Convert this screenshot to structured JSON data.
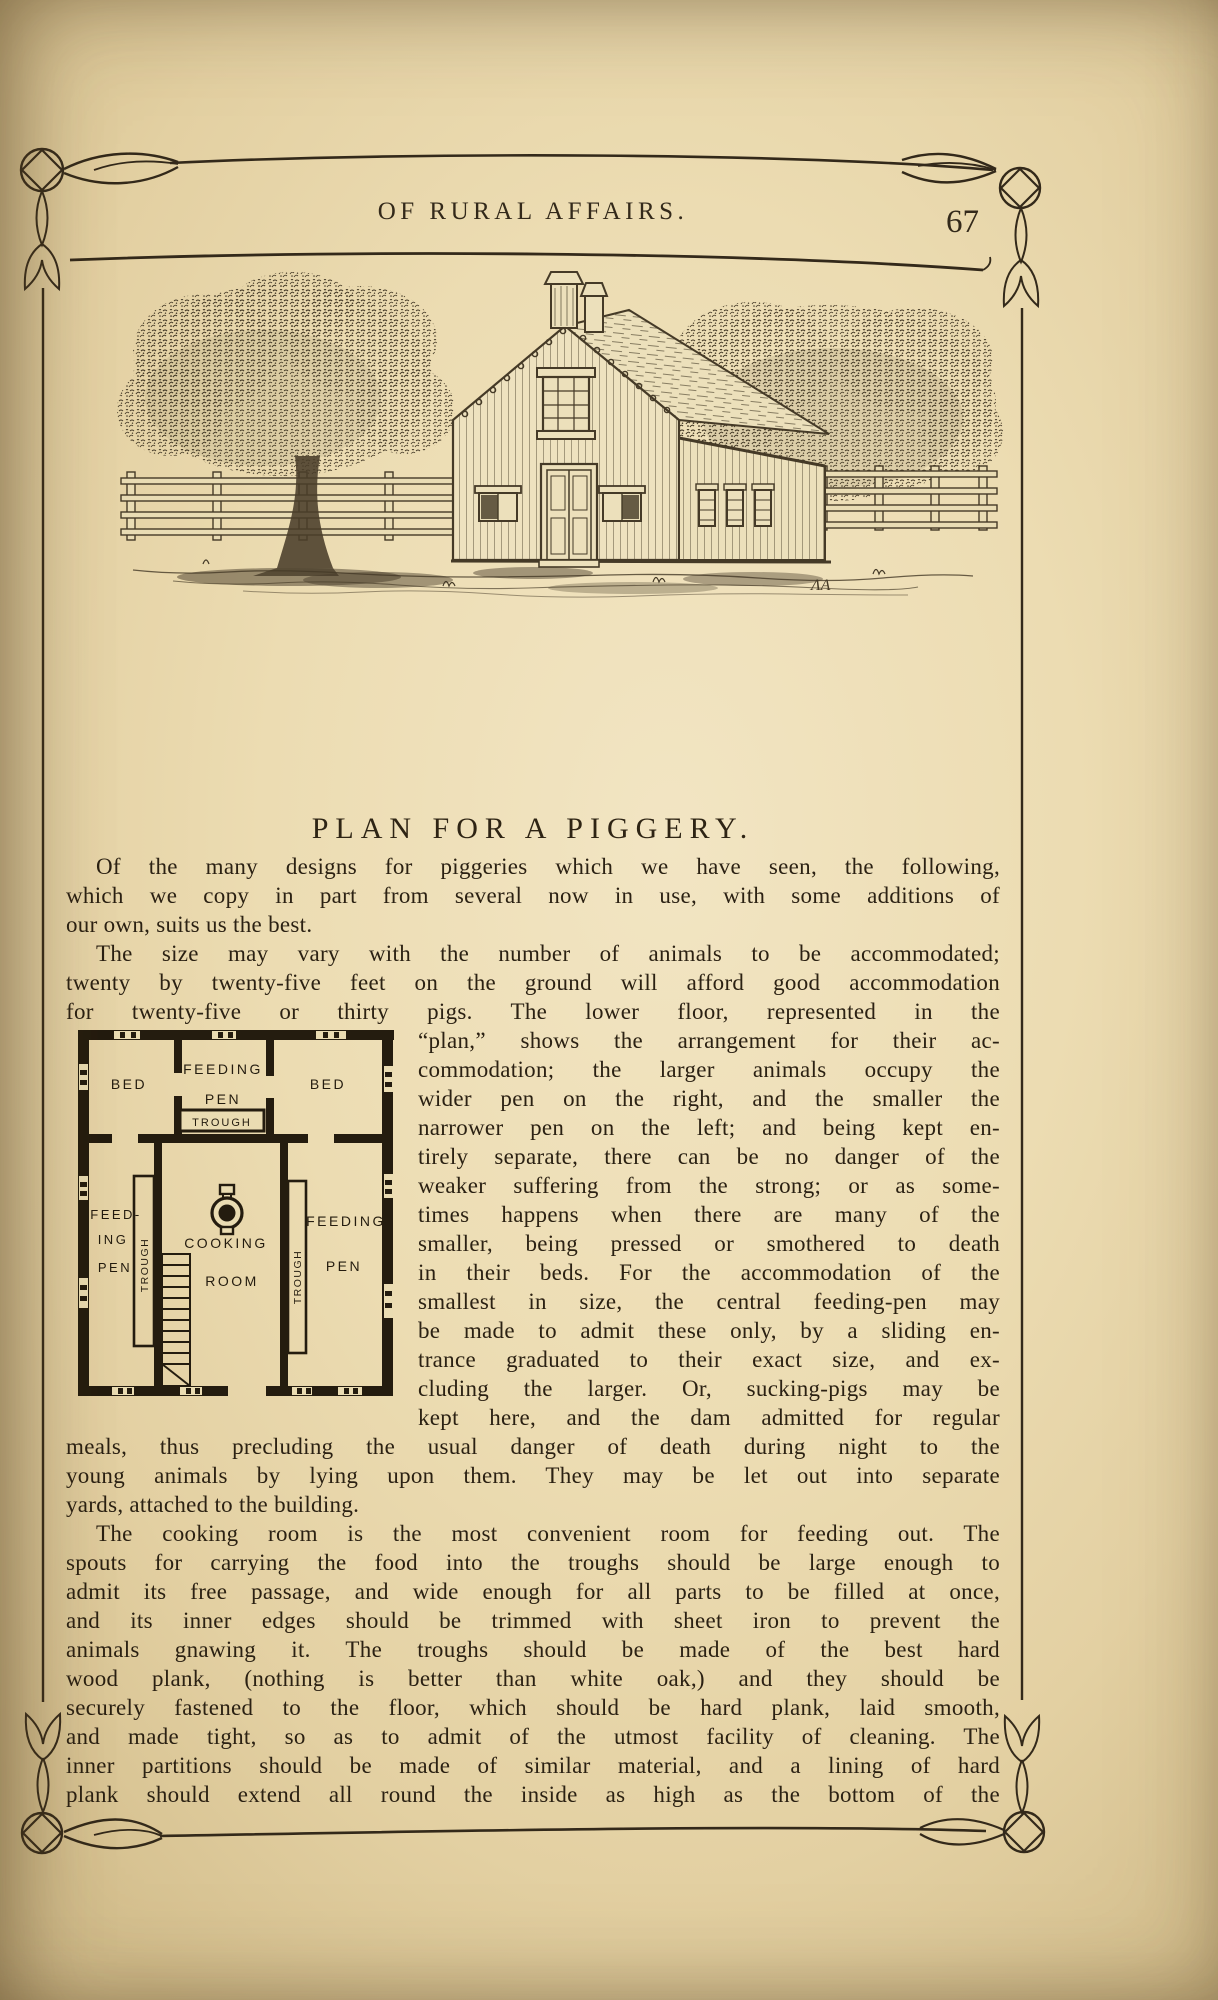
{
  "page": {
    "running_title": "OF RURAL AFFAIRS.",
    "number": "67"
  },
  "engraving": {
    "signature": "ΛA"
  },
  "article": {
    "heading": "PLAN FOR A PIGGERY.",
    "paragraph1": {
      "lines": [
        "Of the many designs for piggeries which we have seen, the following,",
        "which we copy in part from several now in use, with some additions of",
        "our own, suits us the best."
      ]
    },
    "paragraph2": {
      "lines_full": [
        "The size may vary with the number of animals to be accommodated;",
        "twenty by twenty-five feet on the ground will afford good accommodation",
        "for twenty-five or thirty pigs.  The lower floor, represented in the"
      ],
      "lines_beside_plan": [
        "“plan,” shows the arrangement for their ac-",
        "commodation; the larger animals occupy the",
        "wider pen on the right, and the smaller the",
        "narrower pen on the left; and being kept en-",
        "tirely separate, there can be no danger of the",
        "weaker suffering from the strong; or as some-",
        "times happens when there are many of the",
        "smaller, being pressed or smothered to death",
        "in their beds.  For the accommodation of the",
        "smallest in size, the central feeding-pen may",
        "be made to admit these only, by a sliding en-",
        "trance graduated to their exact size, and ex-",
        "cluding the larger.  Or, sucking-pigs may be",
        "kept here, and the dam admitted for regular"
      ],
      "lines_full_cont": [
        "meals, thus precluding the usual danger of death during night to the",
        "young animals by lying upon them.  They may be let out into separate",
        "yards, attached to the building."
      ]
    },
    "paragraph3": {
      "lines": [
        "The cooking room is the most convenient room for feeding out.  The",
        "spouts for carrying the food into the troughs should be large enough to",
        "admit its free passage, and wide enough for all parts to be filled at once,",
        "and its inner edges should be trimmed with sheet iron to prevent the",
        "animals gnawing it.  The troughs should be made of the best hard",
        "wood plank, (nothing is better than white oak,) and they should be",
        "securely fastened to the floor, which should be hard plank, laid smooth,",
        "and made tight, so as to admit of the utmost facility of cleaning.  The",
        "inner partitions should be made of similar material, and a lining of hard",
        "plank should extend all round the inside as high as the bottom of the"
      ]
    }
  },
  "floor_plan": {
    "labels": {
      "bed_left": "BED",
      "feeding_top_1": "FEEDING",
      "feeding_top_2": "PEN",
      "trough_top": "TROUGH",
      "bed_right": "BED",
      "feed_left_1": "FEED-",
      "feed_left_2": "ING",
      "feed_left_3": "PEN",
      "trough_left": "TROUGH",
      "cooking_1": "COOKING",
      "cooking_2": "ROOM",
      "trough_right": "TROUGH",
      "feeding_right_1": "FEEDING",
      "feeding_right_2": "PEN"
    }
  },
  "colors": {
    "paper": "#eadcb2",
    "ink": "#2b2113",
    "engraving_ink": "#453a27"
  }
}
